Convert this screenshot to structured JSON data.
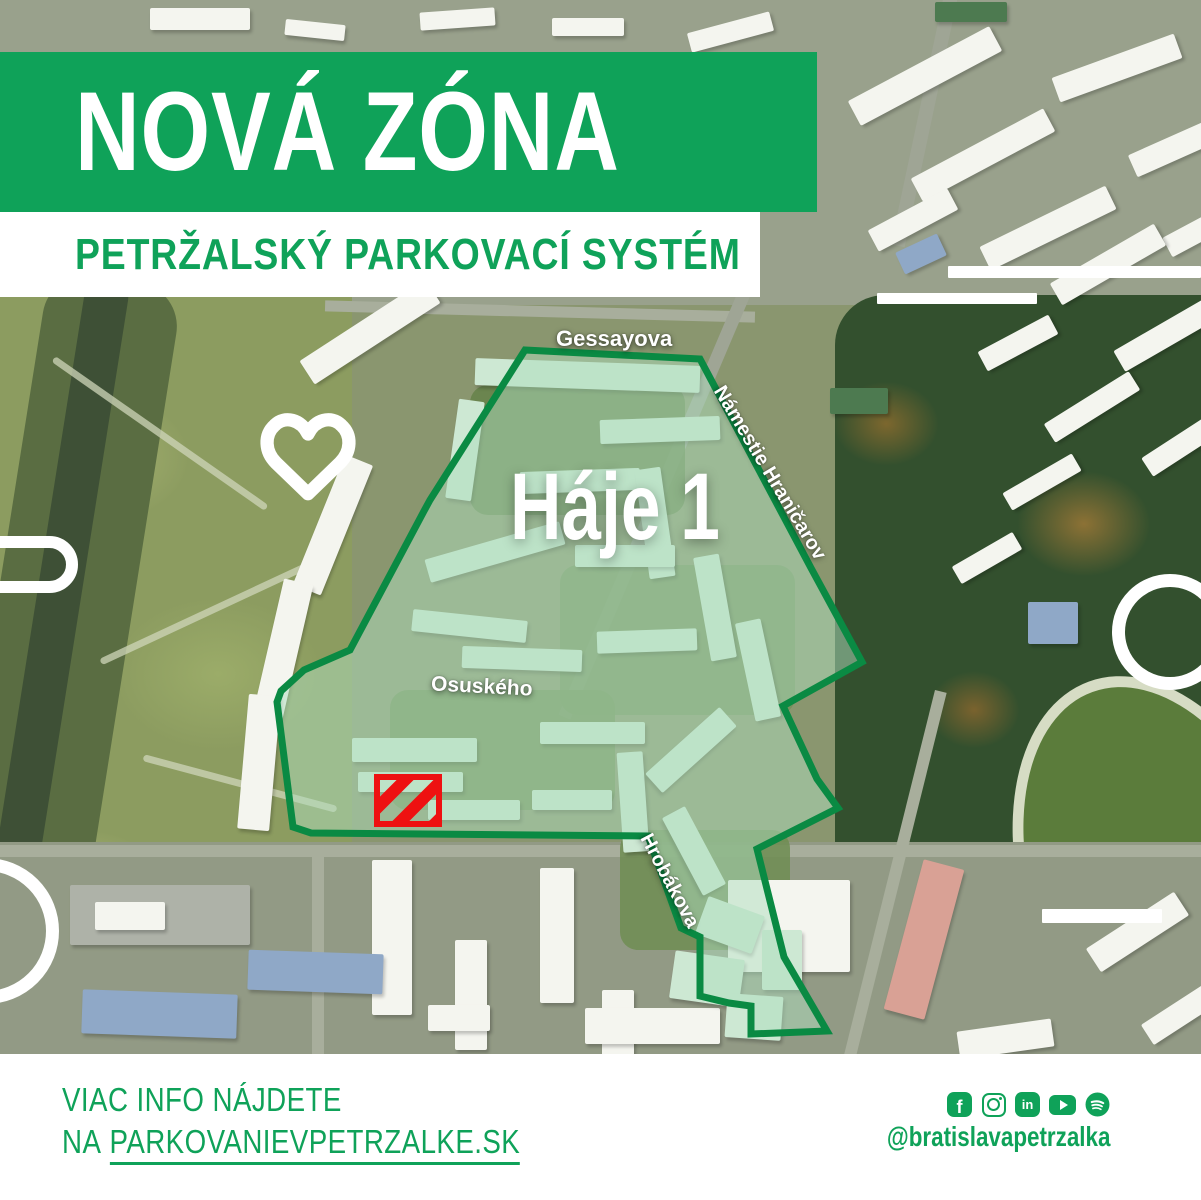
{
  "header": {
    "banner_title": "NOVÁ ZÓNA",
    "subtitle": "PETRŽALSKÝ PARKOVACÍ SYSTÉM"
  },
  "map": {
    "zone_name": "Háje 1",
    "streets": {
      "gessayova": "Gessayova",
      "namestie_hranicarov": "Námestie Hraničarov",
      "osuskeho": "Osuského",
      "hrobakova": "Hrobákova"
    }
  },
  "footer": {
    "info_line1": "VIAC INFO NÁJDETE",
    "info_line2_prefix": "NA",
    "website": "PARKOVANIEVPETRZALKE.SK",
    "social_handle": "@bratislavapetrzalka"
  },
  "icons": {
    "facebook_glyph": "f",
    "linkedin_glyph": "in",
    "social": [
      "facebook",
      "instagram",
      "linkedin",
      "youtube",
      "spotify"
    ]
  },
  "colors": {
    "brand_green": "#0FA259",
    "zone_stroke": "#0A8A43",
    "zone_fill": "rgba(173,222,189,0.5)",
    "marker_red": "#EE1111"
  }
}
